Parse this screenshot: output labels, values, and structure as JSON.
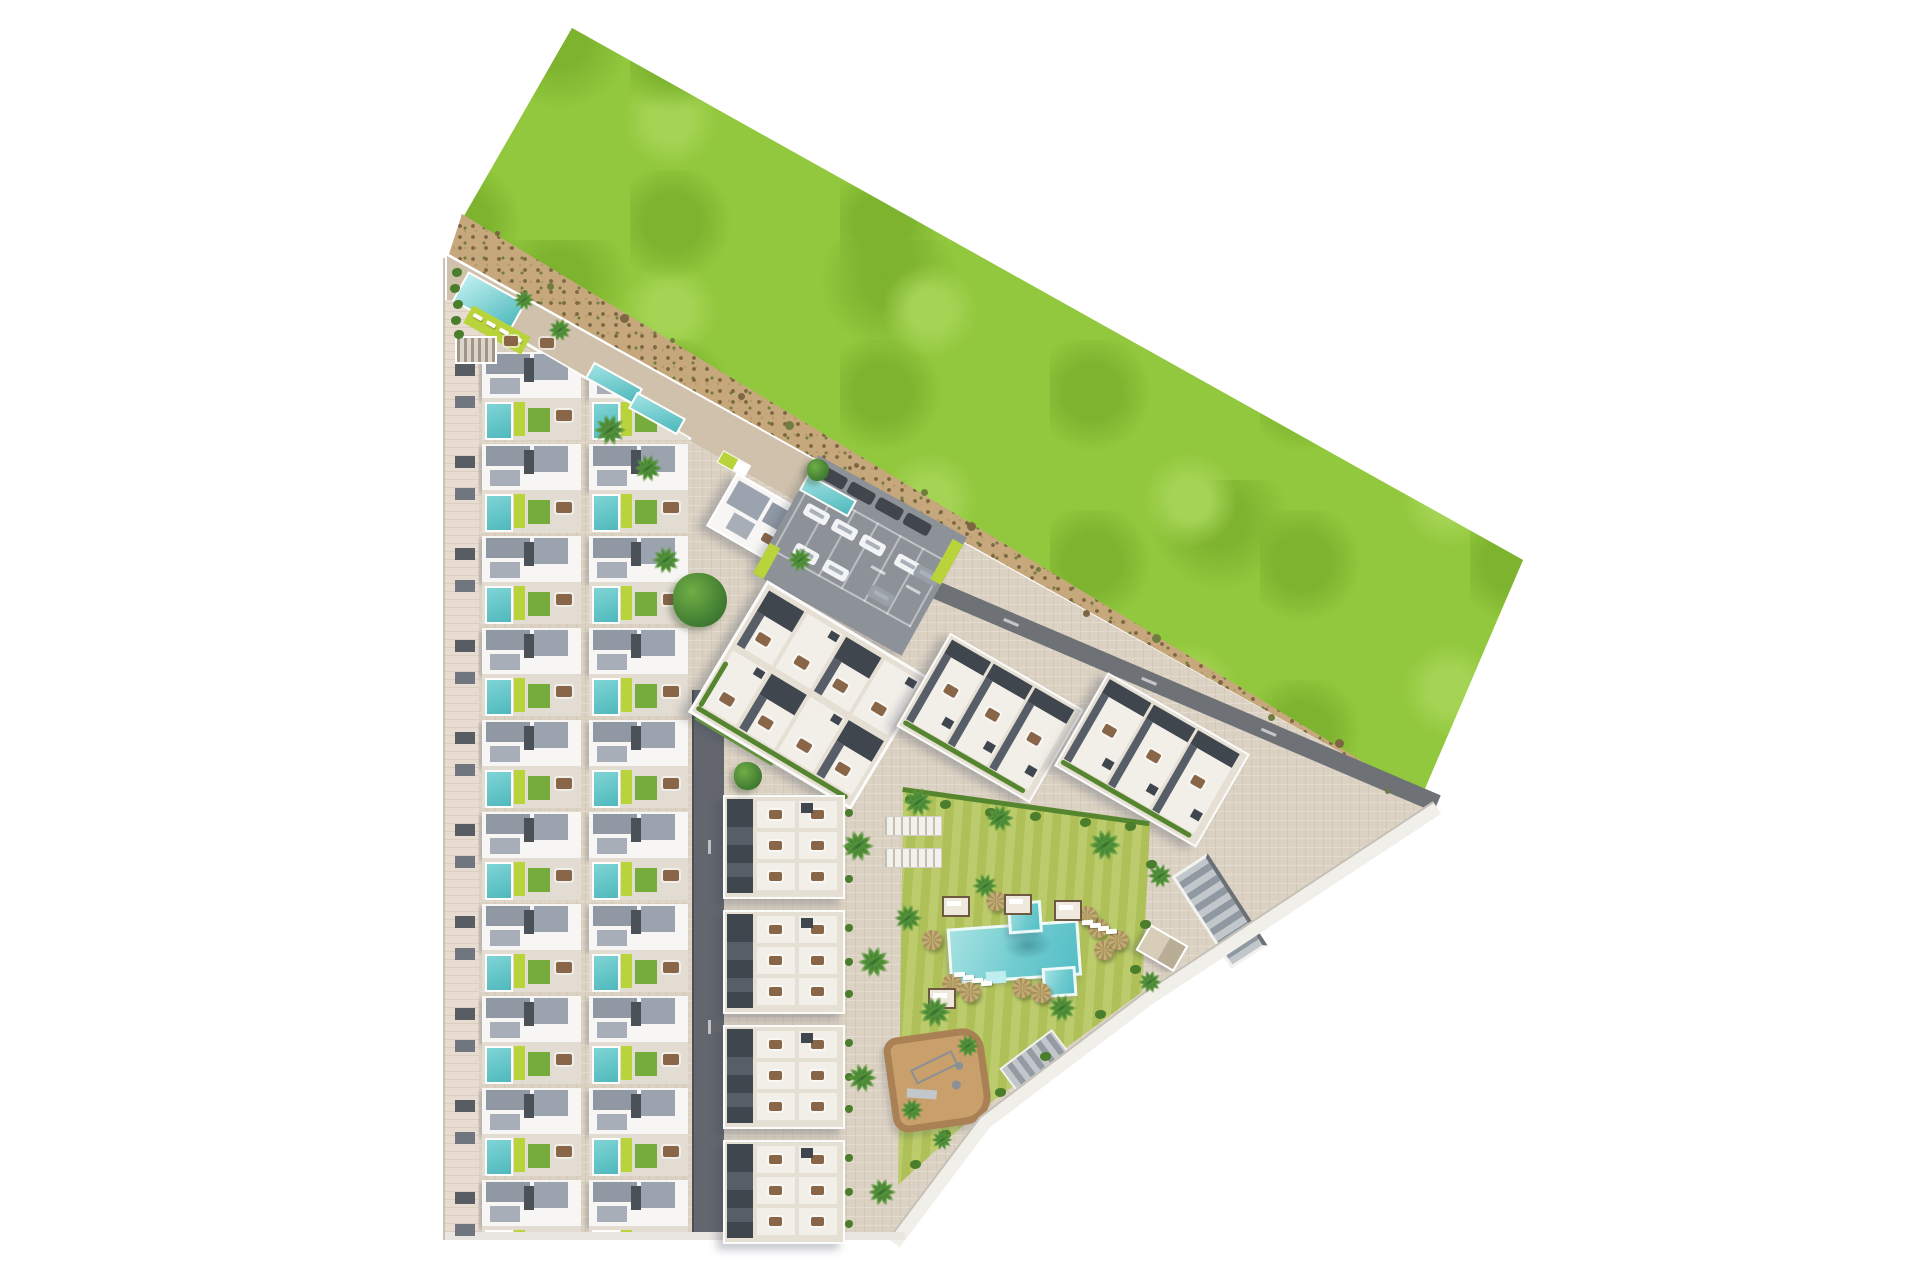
{
  "scene": {
    "title": "aerial-residential-masterplan-render",
    "background": "#ffffff",
    "colors": {
      "grass": "#92c83d",
      "grassDark": "#7db32f",
      "grassLight": "#a5d455",
      "dirt": "#c7a87d",
      "dirtDark": "#7d6743",
      "dirtGreen": "#6f7d3f",
      "base": "#dcd2c3",
      "promenade": "#cfc1ab",
      "sidewalk": "#e7dccf",
      "fence": "#c9c2b8",
      "boundary": "#f1efea",
      "boundaryLine": "#c5c0b6",
      "roadDark": "#6e7277",
      "road": "#63676d",
      "asphalt": "#8d9299",
      "wallWhite": "#f7f6f4",
      "roofGray": "#8f98a3",
      "roofGrayLight": "#9aa3ae",
      "roofDark": "#3f464e",
      "roofMid": "#575e67",
      "terrace": "#e2dcd2",
      "terraceWhite": "#f2efe9",
      "poolWater": "#6fcbcf",
      "poolDeep": "#4fb9bc",
      "poolRim": "#bfeef0",
      "lawn": "#76ac3b",
      "lime": "#b9d33a",
      "gardenLawn": "#b4c65c",
      "hedge": "#55862f",
      "bush": "#4a7d2c",
      "palm": "#57953b",
      "palmDark": "#2e6b2e",
      "furniture": "#8a6648",
      "parasol": "#c4ad74",
      "parasolDark": "#a8915c",
      "playgroundSand": "#c9a06b",
      "playgroundRim": "#aa8055",
      "carWhite": "#f2f3f4",
      "carGray": "#9aa0a7",
      "carDark": "#41464c",
      "pavilion": "#d8cdb8"
    },
    "areas": {
      "grass_field": "undeveloped grass field",
      "dirt_path": "perimeter dirt track with shrubs",
      "development": "residential development site with townhouses, apartment blocks, parking, garden and pool"
    },
    "townhouses": {
      "rows": 10,
      "units_per_row": 2,
      "balcony_knobs_per_row": 2
    },
    "amenity_corner": {
      "pool": 1,
      "loungers": 4,
      "dining_sets": 2,
      "pergola": 1
    },
    "lap_pools": 3,
    "apartment_block_a": {
      "roof_sections": 3,
      "dining_sets": 2
    },
    "parking": {
      "vans_dark": 4,
      "cars_white": 6,
      "cars_gray": 2,
      "green_islands": 2,
      "lane_dashes": 2
    },
    "block_b": {
      "cols": 4,
      "rows": 2
    },
    "block_c": [
      {
        "units": 3
      },
      {
        "units": 3
      }
    ],
    "column_d": {
      "blocks": 4,
      "terrace_cells_per_block": 6
    },
    "garden": {
      "parasols": 10,
      "loungers": 8,
      "cabanas": 4,
      "pergolas": 2,
      "bushes": 14
    },
    "pool": {
      "sections": 3,
      "steps": 1
    },
    "playground": {
      "equipment_items": 4
    },
    "ramps": 2,
    "pavilions": 1,
    "palms": 22,
    "round_trees": 3,
    "dirt_shrubs": 16,
    "road_dashes": {
      "r2": 3,
      "r1": 2
    }
  }
}
